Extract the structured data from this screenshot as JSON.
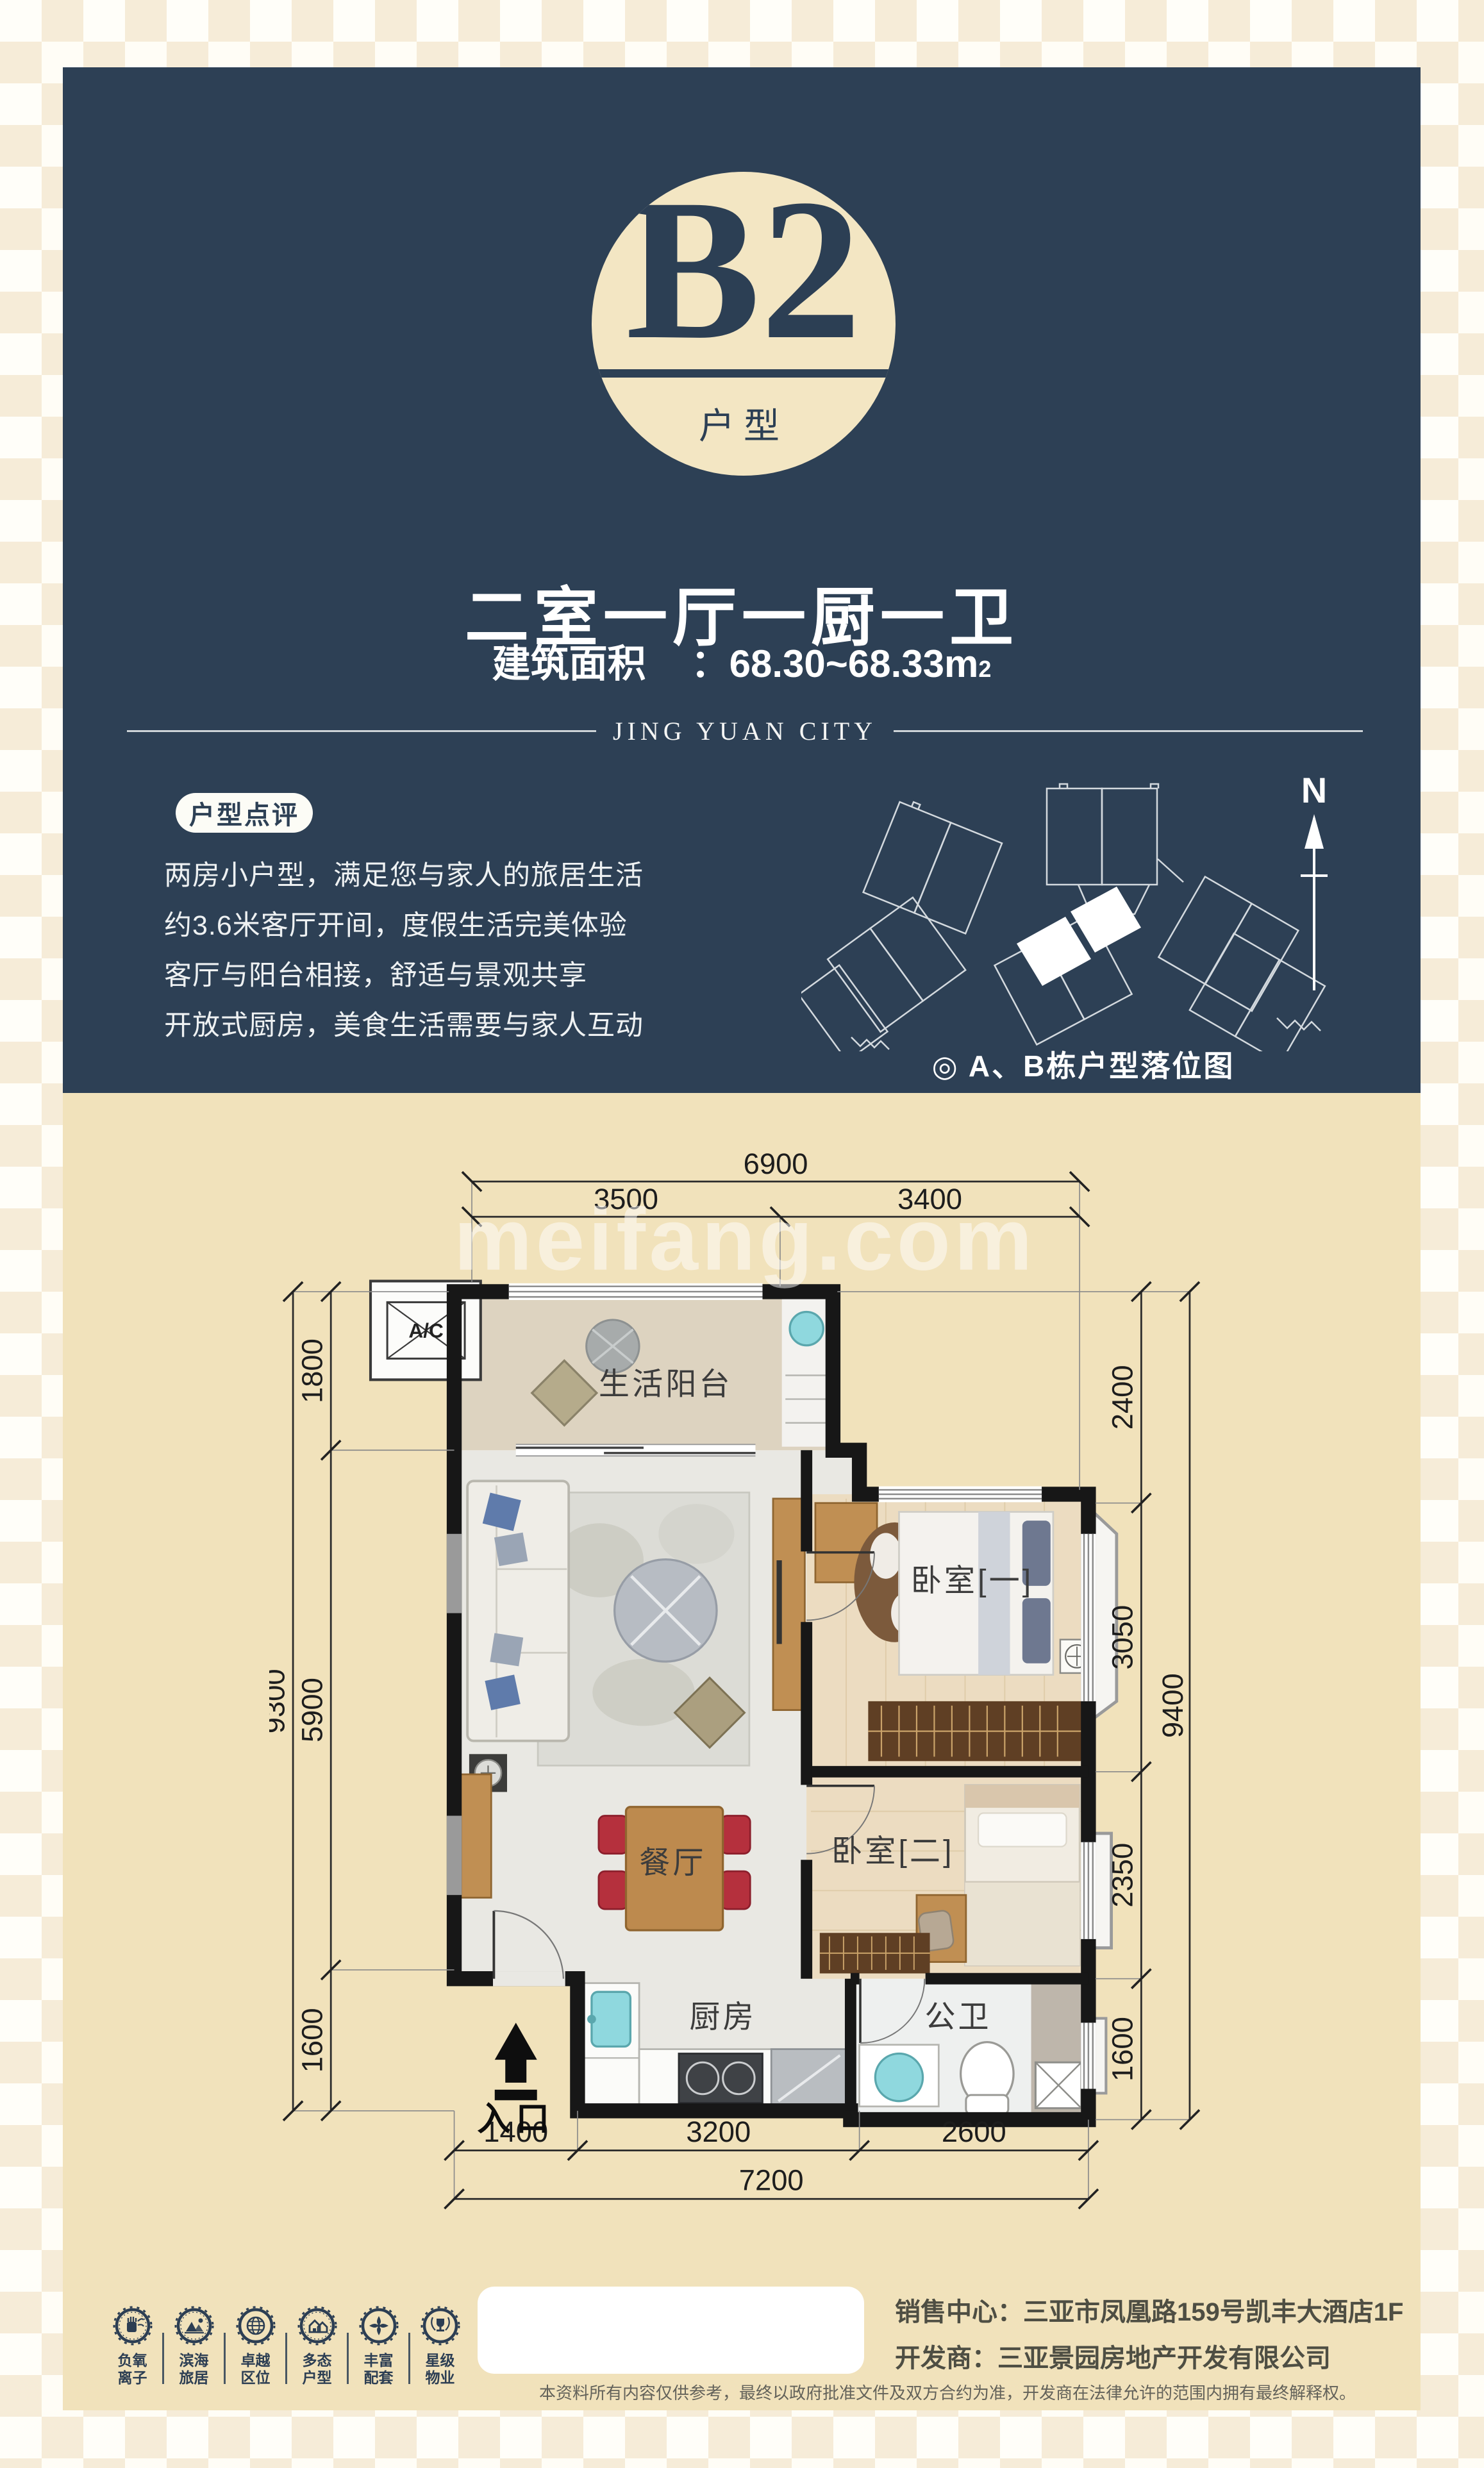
{
  "colors": {
    "navy": "#2d4055",
    "cream": "#f1e2bb",
    "badge_cream": "#f3e6c3",
    "chair_red": "#b5303d",
    "sink_cyan": "#8fd8de"
  },
  "header": {
    "badge": {
      "letter": "B2",
      "sub": "户型"
    },
    "title": "二室一厅一厨一卫",
    "area_label": "建筑面积",
    "area_colon": "：",
    "area_value": "68.30~68.33m",
    "area_sup": "2",
    "brand": "JING YUAN CITY",
    "review_badge": "户型点评",
    "review_lines": [
      "两房小户型，满足您与家人的旅居生活",
      "约3.6米客厅开间，度假生活完美体验",
      "客厅与阳台相接，舒适与景观共享",
      "开放式厨房，美食生活需要与家人互动"
    ],
    "north": "N",
    "sitemap_caption": "◎ A、B栋户型落位图"
  },
  "plan": {
    "watermark": "meifang.com",
    "rooms": {
      "balcony": "生活阳台",
      "bedroom1": "卧室[一]",
      "bedroom2": "卧室[二]",
      "dining": "餐厅",
      "kitchen": "厨房",
      "bath": "公卫",
      "entry": "入口",
      "ac": "A/C"
    },
    "dims": {
      "top_total": "6900",
      "top_seg1": "3500",
      "top_seg2": "3400",
      "left_total": "9300",
      "left_seg1": "1800",
      "left_seg2": "5900",
      "left_seg3": "1600",
      "right_total": "9400",
      "right_seg1": "2400",
      "right_seg2": "3050",
      "right_seg3": "2350",
      "right_seg4": "1600",
      "bottom_seg1": "1400",
      "bottom_seg2": "3200",
      "bottom_seg3": "2600",
      "bottom_total": "7200"
    }
  },
  "footer": {
    "features": [
      {
        "line1": "负氧",
        "line2": "离子"
      },
      {
        "line1": "滨海",
        "line2": "旅居"
      },
      {
        "line1": "卓越",
        "line2": "区位"
      },
      {
        "line1": "多态",
        "line2": "户型"
      },
      {
        "line1": "丰富",
        "line2": "配套"
      },
      {
        "line1": "星级",
        "line2": "物业"
      }
    ],
    "sales_center": "销售中心：三亚市凤凰路159号凯丰大酒店1F",
    "developer": "开发商：三亚景园房地产开发有限公司",
    "disclaimer": "本资料所有内容仅供参考，最终以政府批准文件及双方合约为准，开发商在法律允许的范围内拥有最终解释权。"
  }
}
